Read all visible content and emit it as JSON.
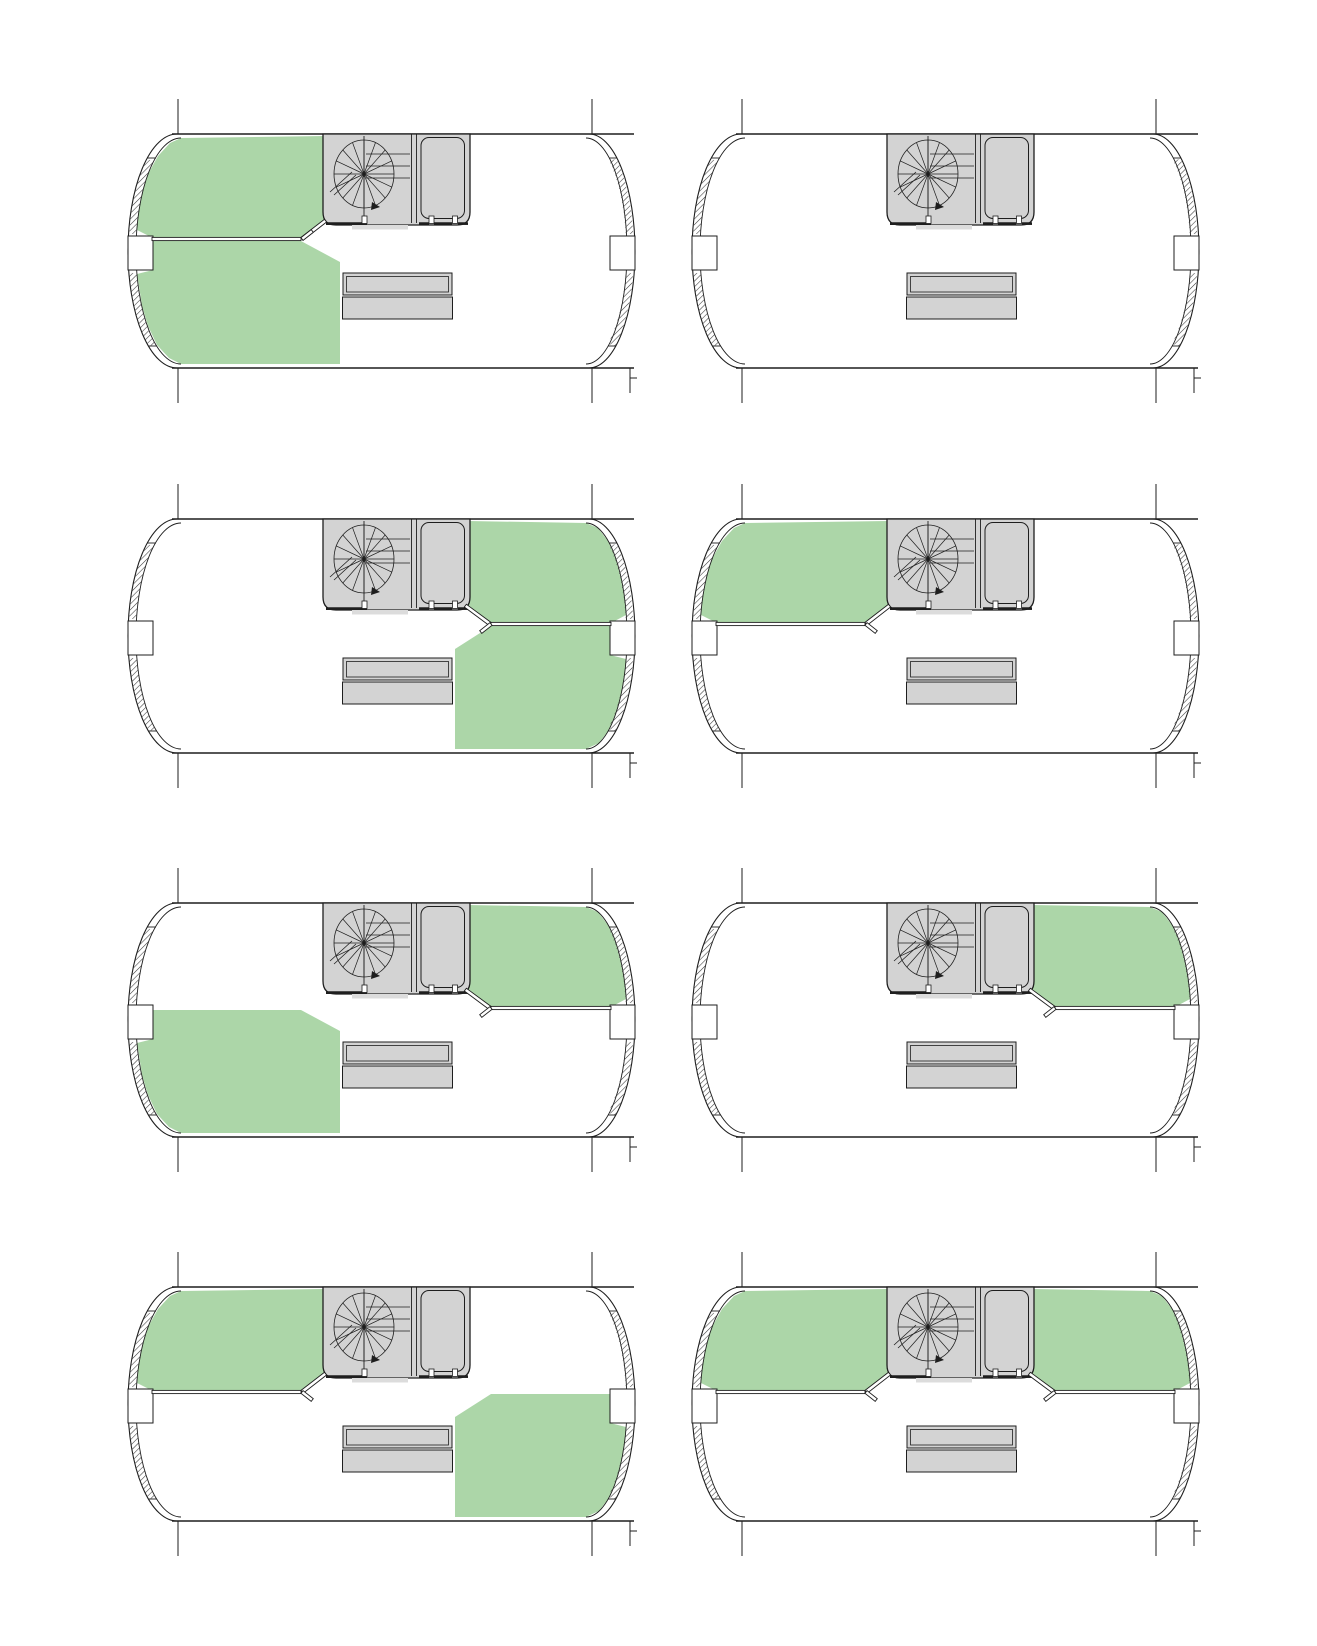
{
  "document": {
    "kind": "architectural-floor-plan-variant-sheet",
    "background": "#ffffff",
    "plan_count": 8
  },
  "palette": {
    "highlight_green": "#acd6a8",
    "fixture_gray": "#d3d3d3",
    "landing_gray": "#dcdcdc",
    "line": "#1e1e1e",
    "hatch_line": "#3a3a3a",
    "panel_white": "#ffffff"
  },
  "grid": {
    "rows": 4,
    "cols": 2
  },
  "zone_ids": [
    "upper-left",
    "upper-right",
    "lower-left",
    "lower-right"
  ],
  "fixture_names": {
    "stair": "spiral-staircase",
    "core": "stair-core-closet",
    "furniture": "double-counter-table",
    "glazing": "curved-window-wall"
  },
  "plans": [
    {
      "id": 1,
      "row": 0,
      "col": 0,
      "green_zones": [
        "upper-left",
        "lower-left"
      ],
      "partitions": [
        "left"
      ],
      "door_flip": true
    },
    {
      "id": 2,
      "row": 0,
      "col": 1,
      "green_zones": [],
      "partitions": [],
      "door_flip": false
    },
    {
      "id": 3,
      "row": 1,
      "col": 0,
      "green_zones": [
        "upper-right",
        "lower-right"
      ],
      "partitions": [
        "right"
      ],
      "door_flip": false
    },
    {
      "id": 4,
      "row": 1,
      "col": 1,
      "green_zones": [
        "upper-left"
      ],
      "partitions": [
        "left"
      ],
      "door_flip": false
    },
    {
      "id": 5,
      "row": 2,
      "col": 0,
      "green_zones": [
        "upper-right",
        "lower-left"
      ],
      "partitions": [
        "right"
      ],
      "door_flip": false
    },
    {
      "id": 6,
      "row": 2,
      "col": 1,
      "green_zones": [
        "upper-right"
      ],
      "partitions": [
        "right"
      ],
      "door_flip": false
    },
    {
      "id": 7,
      "row": 3,
      "col": 0,
      "green_zones": [
        "upper-left",
        "lower-right"
      ],
      "partitions": [
        "left"
      ],
      "door_flip": false
    },
    {
      "id": 8,
      "row": 3,
      "col": 1,
      "green_zones": [
        "upper-left",
        "upper-right"
      ],
      "partitions": [
        "left",
        "right"
      ],
      "door_flip": false
    }
  ]
}
